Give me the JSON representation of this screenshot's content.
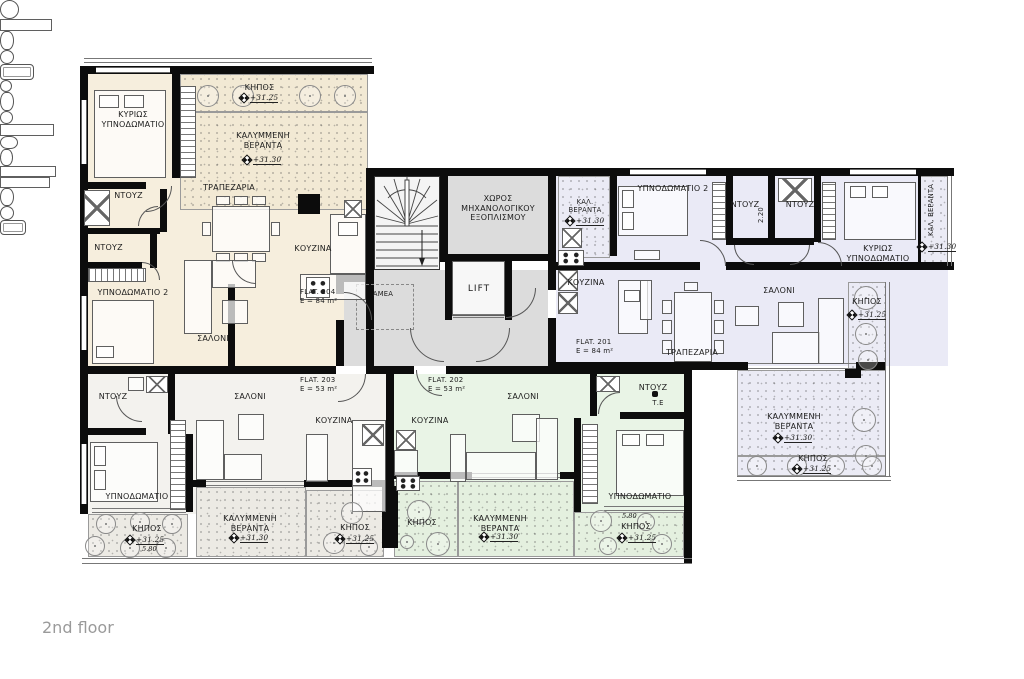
{
  "page": {
    "floor_label": "2nd floor"
  },
  "core": {
    "mech_room": "ΧΩΡΟΣ ΜΗΧΑΝΟΛΟΓΙΚΟΥ ΕΞΟΠΛΙΣΜΟΥ",
    "lift": "LIFT",
    "amea": "ΑΜΕΑ"
  },
  "flat204": {
    "id": "FLAT. 204",
    "area": "E = 84 m²",
    "master_bedroom": "ΚΥΡΙΩΣ ΥΠΝΟΔΩΜΑΤΙΟ",
    "bedroom2": "ΥΠΝΟΔΩΜΑΤΙΟ 2",
    "shower_top": "ΝΤΟΥΖ",
    "shower_bottom": "ΝΤΟΥΖ",
    "dining": "ΤΡΑΠΕΖΑΡΙΑ",
    "kitchen": "ΚΟΥΖΙΝΑ",
    "living": "ΣΑΛΟΝΙ",
    "garden": "ΚΗΠΟΣ",
    "garden_level": "+31.25",
    "veranda": "ΚΑΛΥΜΜΕΝΗ ΒΕΡΑΝΤΑ",
    "veranda_level": "+31.30"
  },
  "flat201": {
    "id": "FLAT. 201",
    "area": "E = 84 m²",
    "bedroom2": "ΥΠΝΟΔΩΜΑΤΙΟ 2",
    "shower_left": "ΝΤΟΥΖ",
    "shower_right": "ΝΤΟΥΖ",
    "dim": "2.20",
    "master_bedroom": "ΚΥΡΙΩΣ ΥΠΝΟΔΩΜΑΤΙΟ",
    "kitchen": "ΚΟΥΖΙΝΑ",
    "living": "ΣΑΛΟΝΙ",
    "dining": "ΤΡΑΠΕΖΑΡΙΑ",
    "balcony_top": "ΚΑΛ. ΒΕΡΑΝΤΑ",
    "balcony_top_level": "+31.30",
    "balcony_right": "ΚΑΛ. ΒΕΡΑΝΤΑ",
    "balcony_right_level": "+31.30",
    "garden_right": "ΚΗΠΟΣ",
    "garden_right_level": "+31.25",
    "veranda": "ΚΑΛΥΜΜΕΝΗ ΒΕΡΑΝΤΑ",
    "veranda_level": "+31.30",
    "garden_bottom": "ΚΗΠΟΣ",
    "garden_bottom_level": "+31.25"
  },
  "flat203": {
    "id": "FLAT. 203",
    "area": "E = 53 m²",
    "shower": "ΝΤΟΥΖ",
    "living": "ΣΑΛΟΝΙ",
    "kitchen": "ΚΟΥΖΙΝΑ",
    "bedroom": "ΥΠΝΟΔΩΜΑΤΙΟ",
    "garden_left": "ΚΗΠΟΣ",
    "garden_left_level": "+31.25",
    "garden_left_dim": "5.80",
    "veranda": "ΚΑΛΥΜΜΕΝΗ ΒΕΡΑΝΤΑ",
    "veranda_level": "+31.30",
    "garden_right": "ΚΗΠΟΣ",
    "garden_right_level": "+31.25"
  },
  "flat202": {
    "id": "FLAT. 202",
    "area": "E = 53 m²",
    "living": "ΣΑΛΟΝΙ",
    "kitchen": "ΚΟΥΖΙΝΑ",
    "shower": "ΝΤΟΥΖ",
    "te": "Τ.Ε",
    "bedroom": "ΥΠΝΟΔΩΜΑΤΙΟ",
    "garden_left": "ΚΗΠΟΣ",
    "veranda": "ΚΑΛΥΜΜΕΝΗ ΒΕΡΑΝΤΑ",
    "veranda_level": "+31.30",
    "garden_right": "ΚΗΠΟΣ",
    "garden_right_level": "+31.25",
    "garden_right_dim": "5.80"
  },
  "colors": {
    "flat204": "#f6eedd",
    "flat201": "#eaeaf6",
    "flat203": "#f3f2ee",
    "flat202": "#e9f4e6",
    "corridor": "#dcdcdc",
    "wall": "#0c0c0c"
  }
}
